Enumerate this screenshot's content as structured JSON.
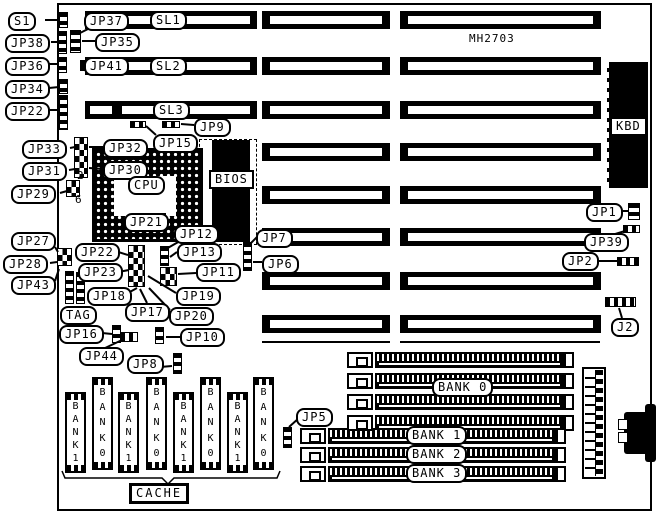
{
  "board_label": {
    "text": "MH2703",
    "x": 469,
    "y": 32
  },
  "board": {
    "x": 57,
    "y": 3,
    "w": 595,
    "h": 508
  },
  "slots": {
    "row_y": [
      11,
      57,
      101,
      143,
      186,
      228,
      272,
      315
    ],
    "height": 18,
    "rows_with_left": 3,
    "left_seg": [
      85,
      257
    ],
    "left_stripes": [
      [
        90,
        112
      ],
      [
        122,
        250
      ]
    ],
    "mid_seg": [
      262,
      390
    ],
    "right_seg": [
      400,
      601
    ],
    "under_line_y": 341,
    "under_lines": [
      [
        262,
        390
      ],
      [
        400,
        600
      ]
    ]
  },
  "callouts": [
    {
      "text": "S1",
      "x": 8,
      "y": 12
    },
    {
      "text": "JP37",
      "x": 84,
      "y": 12
    },
    {
      "text": "SL1",
      "x": 150,
      "y": 11
    },
    {
      "text": "JP38",
      "x": 5,
      "y": 34
    },
    {
      "text": "JP35",
      "x": 95,
      "y": 33
    },
    {
      "text": "JP36",
      "x": 5,
      "y": 57
    },
    {
      "text": "JP41",
      "x": 84,
      "y": 57
    },
    {
      "text": "SL2",
      "x": 150,
      "y": 57
    },
    {
      "text": "JP34",
      "x": 5,
      "y": 80
    },
    {
      "text": "JP22",
      "x": 5,
      "y": 102
    },
    {
      "text": "SL3",
      "x": 153,
      "y": 101
    },
    {
      "text": "JP9",
      "x": 194,
      "y": 118
    },
    {
      "text": "JP33",
      "x": 22,
      "y": 140
    },
    {
      "text": "JP32",
      "x": 103,
      "y": 139
    },
    {
      "text": "JP15",
      "x": 153,
      "y": 134
    },
    {
      "text": "JP31",
      "x": 22,
      "y": 162
    },
    {
      "text": "JP30",
      "x": 103,
      "y": 161
    },
    {
      "text": "JP29",
      "x": 11,
      "y": 185
    },
    {
      "text": "CPU",
      "x": 128,
      "y": 176
    },
    {
      "text": "JP21",
      "x": 124,
      "y": 213
    },
    {
      "text": "JP12",
      "x": 174,
      "y": 225
    },
    {
      "text": "JP1",
      "x": 586,
      "y": 203
    },
    {
      "text": "JP39",
      "x": 584,
      "y": 233
    },
    {
      "text": "JP2",
      "x": 562,
      "y": 252
    },
    {
      "text": "JP27",
      "x": 11,
      "y": 232
    },
    {
      "text": "JP7",
      "x": 256,
      "y": 229
    },
    {
      "text": "JP22",
      "x": 75,
      "y": 243
    },
    {
      "text": "JP13",
      "x": 177,
      "y": 243
    },
    {
      "text": "JP28",
      "x": 3,
      "y": 255
    },
    {
      "text": "JP23",
      "x": 78,
      "y": 263
    },
    {
      "text": "JP6",
      "x": 262,
      "y": 255
    },
    {
      "text": "JP11",
      "x": 196,
      "y": 263
    },
    {
      "text": "JP43",
      "x": 11,
      "y": 276
    },
    {
      "text": "JP18",
      "x": 87,
      "y": 287
    },
    {
      "text": "JP19",
      "x": 176,
      "y": 287
    },
    {
      "text": "TAG",
      "x": 60,
      "y": 306
    },
    {
      "text": "JP17",
      "x": 125,
      "y": 303
    },
    {
      "text": "JP20",
      "x": 169,
      "y": 307
    },
    {
      "text": "JP16",
      "x": 59,
      "y": 325
    },
    {
      "text": "JP10",
      "x": 180,
      "y": 328
    },
    {
      "text": "JP44",
      "x": 79,
      "y": 347
    },
    {
      "text": "JP8",
      "x": 127,
      "y": 355
    },
    {
      "text": "J2",
      "x": 611,
      "y": 318
    },
    {
      "text": "JP5",
      "x": 296,
      "y": 408
    },
    {
      "text": "BANK 0",
      "x": 432,
      "y": 378
    },
    {
      "text": "BANK 1",
      "x": 406,
      "y": 426
    },
    {
      "text": "BANK 2",
      "x": 406,
      "y": 445
    },
    {
      "text": "BANK 3",
      "x": 406,
      "y": 464
    }
  ],
  "digits": [
    {
      "text": "2",
      "x": 77,
      "y": 169
    },
    {
      "text": "6",
      "x": 75,
      "y": 193
    }
  ],
  "cpu_socket": {
    "x": 92,
    "y": 148,
    "w": 111,
    "h": 94,
    "hole": {
      "x": 114,
      "y": 176,
      "w": 62,
      "h": 40
    }
  },
  "bios": {
    "dash": {
      "x": 199,
      "y": 139,
      "w": 56,
      "h": 104
    },
    "chip": {
      "x": 212,
      "y": 140,
      "w": 38,
      "h": 102
    },
    "label": {
      "text": "BIOS",
      "x": 209,
      "y": 170
    }
  },
  "kbd": {
    "block": {
      "x": 607,
      "y": 62,
      "w": 41,
      "h": 126
    },
    "label": {
      "text": "KBD",
      "x": 611,
      "y": 118
    }
  },
  "jumpers": [
    {
      "x": 59,
      "y": 12,
      "w": 9,
      "h": 16,
      "p": "rows"
    },
    {
      "x": 58,
      "y": 31,
      "w": 9,
      "h": 23,
      "p": "rows"
    },
    {
      "x": 70,
      "y": 30,
      "w": 11,
      "h": 23,
      "p": "rows"
    },
    {
      "x": 58,
      "y": 57,
      "w": 9,
      "h": 16,
      "p": "rows"
    },
    {
      "x": 80,
      "y": 60,
      "w": 5,
      "h": 11,
      "p": "solid"
    },
    {
      "x": 59,
      "y": 79,
      "w": 9,
      "h": 15,
      "p": "rows"
    },
    {
      "x": 59,
      "y": 95,
      "w": 9,
      "h": 35,
      "p": "rows"
    },
    {
      "x": 74,
      "y": 137,
      "w": 14,
      "h": 41,
      "p": "checker"
    },
    {
      "x": 66,
      "y": 180,
      "w": 14,
      "h": 17,
      "p": "checker"
    },
    {
      "x": 130,
      "y": 121,
      "w": 16,
      "h": 7,
      "p": "cols"
    },
    {
      "x": 162,
      "y": 121,
      "w": 18,
      "h": 7,
      "p": "cols"
    },
    {
      "x": 57,
      "y": 248,
      "w": 15,
      "h": 18,
      "p": "checker"
    },
    {
      "x": 65,
      "y": 271,
      "w": 9,
      "h": 33,
      "p": "rows"
    },
    {
      "x": 76,
      "y": 272,
      "w": 9,
      "h": 32,
      "p": "rows"
    },
    {
      "x": 128,
      "y": 245,
      "w": 17,
      "h": 42,
      "p": "checker"
    },
    {
      "x": 160,
      "y": 246,
      "w": 9,
      "h": 20,
      "p": "rows"
    },
    {
      "x": 160,
      "y": 267,
      "w": 17,
      "h": 19,
      "p": "checker"
    },
    {
      "x": 112,
      "y": 325,
      "w": 9,
      "h": 18,
      "p": "rows"
    },
    {
      "x": 120,
      "y": 332,
      "w": 18,
      "h": 10,
      "p": "cols"
    },
    {
      "x": 155,
      "y": 327,
      "w": 9,
      "h": 17,
      "p": "rows"
    },
    {
      "x": 173,
      "y": 353,
      "w": 9,
      "h": 21,
      "p": "rows"
    },
    {
      "x": 243,
      "y": 242,
      "w": 9,
      "h": 29,
      "p": "rows"
    },
    {
      "x": 628,
      "y": 203,
      "w": 12,
      "h": 17,
      "p": "rows"
    },
    {
      "x": 623,
      "y": 225,
      "w": 17,
      "h": 8,
      "p": "cols"
    },
    {
      "x": 617,
      "y": 257,
      "w": 22,
      "h": 9,
      "p": "cols"
    },
    {
      "x": 605,
      "y": 297,
      "w": 31,
      "h": 10,
      "p": "cols"
    },
    {
      "x": 283,
      "y": 427,
      "w": 9,
      "h": 21,
      "p": "rows"
    },
    {
      "x": 161,
      "y": 213,
      "w": 5,
      "h": 5,
      "p": "solid"
    }
  ],
  "memory": {
    "top_rows_y": [
      352,
      373,
      394,
      415
    ],
    "top": {
      "bracket_x": 347,
      "body_x": 375,
      "body_end": 564,
      "cap_x": 564
    },
    "bottom_rows_y": [
      428,
      447,
      466
    ],
    "bottom": {
      "bracket_x": 300,
      "body_x": 328,
      "body_end": 556,
      "cap_x": 556
    }
  },
  "power_connector": {
    "x": 582,
    "y": 367,
    "w": 24,
    "h": 112
  },
  "din_connector": {
    "rects": [
      {
        "x": 624,
        "y": 412,
        "w": 24,
        "h": 42
      },
      {
        "x": 645,
        "y": 404,
        "w": 11,
        "h": 58
      }
    ],
    "notches": [
      {
        "x": 618,
        "y": 419,
        "w": 8,
        "h": 9
      },
      {
        "x": 618,
        "y": 432,
        "w": 8,
        "h": 9
      }
    ]
  },
  "cache": {
    "chip_w": 21,
    "chips": [
      {
        "x": 65,
        "y": 392,
        "h": 81,
        "text": "BANK1"
      },
      {
        "x": 92,
        "y": 377,
        "h": 93,
        "text": "BANK0"
      },
      {
        "x": 118,
        "y": 392,
        "h": 81,
        "text": "BANK1"
      },
      {
        "x": 146,
        "y": 377,
        "h": 93,
        "text": "BANK0"
      },
      {
        "x": 173,
        "y": 392,
        "h": 81,
        "text": "BANK1"
      },
      {
        "x": 200,
        "y": 377,
        "h": 93,
        "text": "BANK0"
      },
      {
        "x": 227,
        "y": 392,
        "h": 81,
        "text": "BANK1"
      },
      {
        "x": 253,
        "y": 377,
        "h": 93,
        "text": "BANK0"
      }
    ],
    "label": {
      "text": "CACHE",
      "x": 129,
      "y": 483
    },
    "brace": "M62,471 L65,478 L162,478 L168,484 L174,478 L277,478 L280,471"
  },
  "leader_lines": [
    [
      45,
      20,
      59,
      20
    ],
    [
      90,
      28,
      78,
      34
    ],
    [
      51,
      42,
      58,
      42
    ],
    [
      95,
      41,
      82,
      41
    ],
    [
      49,
      64,
      58,
      64
    ],
    [
      85,
      65,
      81,
      65
    ],
    [
      49,
      88,
      59,
      87
    ],
    [
      49,
      110,
      59,
      110
    ],
    [
      194,
      125,
      181,
      124
    ],
    [
      156,
      135,
      146,
      126
    ],
    [
      70,
      148,
      75,
      147
    ],
    [
      103,
      147,
      89,
      147
    ],
    [
      69,
      170,
      75,
      169
    ],
    [
      103,
      169,
      89,
      168
    ],
    [
      60,
      193,
      67,
      191
    ],
    [
      55,
      247,
      58,
      252
    ],
    [
      50,
      263,
      57,
      262
    ],
    [
      55,
      281,
      59,
      269
    ],
    [
      115,
      251,
      128,
      255
    ],
    [
      118,
      272,
      129,
      270
    ],
    [
      177,
      252,
      170,
      257
    ],
    [
      180,
      241,
      166,
      249
    ],
    [
      196,
      273,
      178,
      274
    ],
    [
      128,
      293,
      137,
      288
    ],
    [
      147,
      303,
      140,
      289
    ],
    [
      176,
      293,
      148,
      276
    ],
    [
      170,
      310,
      149,
      288
    ],
    [
      102,
      333,
      112,
      334
    ],
    [
      103,
      349,
      122,
      340
    ],
    [
      180,
      337,
      166,
      337
    ],
    [
      160,
      367,
      172,
      366
    ],
    [
      257,
      237,
      250,
      244
    ],
    [
      262,
      262,
      253,
      262
    ],
    [
      614,
      211,
      628,
      211
    ],
    [
      612,
      235,
      625,
      231
    ],
    [
      598,
      261,
      617,
      261
    ],
    [
      622,
      318,
      619,
      308
    ],
    [
      299,
      418,
      289,
      427
    ],
    [
      161,
      218,
      164,
      216
    ]
  ]
}
